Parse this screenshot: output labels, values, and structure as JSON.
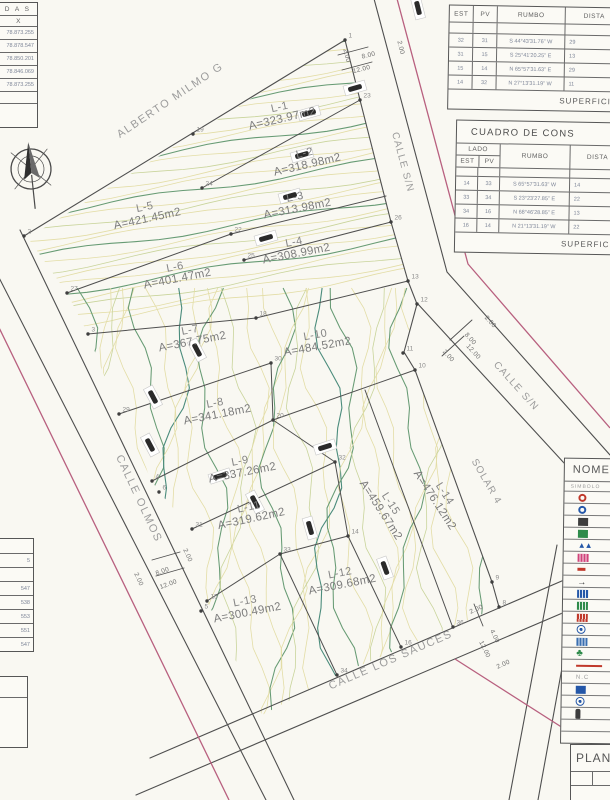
{
  "streets": {
    "alberto_milmo": "ALBERTO MILMO G",
    "calle_sn_top": "CALLE S/N",
    "calle_sn_right": "CALLE S/N",
    "calle_olmos": "CALLE OLMOS",
    "calle_los_sauces": "CALLE LOS SAUCES",
    "solar4": "SOLAR 4"
  },
  "lots": [
    {
      "name": "L-1",
      "area": "A=323.97m2",
      "x": 283,
      "y": 122,
      "r": -13
    },
    {
      "name": "L-2",
      "area": "A=318.98m2",
      "x": 308,
      "y": 168,
      "r": -13
    },
    {
      "name": "L-3",
      "area": "A=313.98m2",
      "x": 298,
      "y": 212,
      "r": -11
    },
    {
      "name": "L-4",
      "area": "A=308.99m2",
      "x": 297,
      "y": 257,
      "r": -11
    },
    {
      "name": "L-5",
      "area": "A=421.45m2",
      "x": 148,
      "y": 222,
      "r": -12
    },
    {
      "name": "L-6",
      "area": "A=401.47m2",
      "x": 178,
      "y": 282,
      "r": -11
    },
    {
      "name": "L-7",
      "area": "A=367.75m2",
      "x": 193,
      "y": 345,
      "r": -11
    },
    {
      "name": "L-8",
      "area": "A=341.18m2",
      "x": 218,
      "y": 418,
      "r": -11
    },
    {
      "name": "L-9",
      "area": "A=337.26m2",
      "x": 243,
      "y": 476,
      "r": -11
    },
    {
      "name": "L-10",
      "area": "A=484.52m2",
      "x": 318,
      "y": 350,
      "r": -10
    },
    {
      "name": "L-11",
      "area": "A=319.62m2",
      "x": 252,
      "y": 522,
      "r": -12
    },
    {
      "name": "L-12",
      "area": "A=309.68m2",
      "x": 343,
      "y": 588,
      "r": -11
    },
    {
      "name": "L-13",
      "area": "A=300.49m2",
      "x": 248,
      "y": 616,
      "r": -11
    },
    {
      "name": "L-14",
      "area": "A=476.12m2",
      "x": 432,
      "y": 502,
      "r": 57
    },
    {
      "name": "L-15",
      "area": "A=459.67m2",
      "x": 378,
      "y": 512,
      "r": 57
    }
  ],
  "vertices": [
    {
      "n": "1",
      "x": 345,
      "y": 40
    },
    {
      "n": "2",
      "x": 24,
      "y": 236
    },
    {
      "n": "3",
      "x": 88,
      "y": 334
    },
    {
      "n": "4",
      "x": 152,
      "y": 481
    },
    {
      "n": "5",
      "x": 201,
      "y": 611
    },
    {
      "n": "6",
      "x": 159,
      "y": 492
    },
    {
      "n": "8",
      "x": 499,
      "y": 607
    },
    {
      "n": "9",
      "x": 492,
      "y": 582
    },
    {
      "n": "10",
      "x": 415,
      "y": 370
    },
    {
      "n": "11",
      "x": 403,
      "y": 353
    },
    {
      "n": "12",
      "x": 417,
      "y": 304
    },
    {
      "n": "13",
      "x": 408,
      "y": 281
    },
    {
      "n": "14",
      "x": 348,
      "y": 536
    },
    {
      "n": "15",
      "x": 207,
      "y": 601
    },
    {
      "n": "16",
      "x": 401,
      "y": 647
    },
    {
      "n": "18",
      "x": 256,
      "y": 318
    },
    {
      "n": "19",
      "x": 193,
      "y": 134
    },
    {
      "n": "20",
      "x": 273,
      "y": 420
    },
    {
      "n": "22",
      "x": 231,
      "y": 234
    },
    {
      "n": "23",
      "x": 360,
      "y": 100
    },
    {
      "n": "24",
      "x": 202,
      "y": 188
    },
    {
      "n": "25",
      "x": 244,
      "y": 260
    },
    {
      "n": "26",
      "x": 391,
      "y": 222
    },
    {
      "n": "27",
      "x": 67,
      "y": 293
    },
    {
      "n": "29",
      "x": 119,
      "y": 414
    },
    {
      "n": "30",
      "x": 271,
      "y": 363
    },
    {
      "n": "31",
      "x": 192,
      "y": 529
    },
    {
      "n": "32",
      "x": 335,
      "y": 462
    },
    {
      "n": "33",
      "x": 280,
      "y": 554
    },
    {
      "n": "34",
      "x": 337,
      "y": 675
    },
    {
      "n": "36",
      "x": 453,
      "y": 627
    }
  ],
  "dim_labels": [
    {
      "t": "8.00",
      "x": 369,
      "y": 57,
      "r": -14
    },
    {
      "t": "12.00",
      "x": 362,
      "y": 71,
      "r": -14
    },
    {
      "t": "2.00",
      "x": 345,
      "y": 56,
      "r": 76
    },
    {
      "t": "2.00",
      "x": 399,
      "y": 48,
      "r": 76
    },
    {
      "t": "2.00",
      "x": 489,
      "y": 323,
      "r": 48
    },
    {
      "t": "8.00",
      "x": 469,
      "y": 340,
      "r": 48
    },
    {
      "t": "12.00",
      "x": 472,
      "y": 353,
      "r": 48
    },
    {
      "t": "2.00",
      "x": 447,
      "y": 357,
      "r": 48
    },
    {
      "t": "2.00",
      "x": 186,
      "y": 556,
      "r": 66
    },
    {
      "t": "8.00",
      "x": 163,
      "y": 573,
      "r": -20
    },
    {
      "t": "12.00",
      "x": 169,
      "y": 586,
      "r": -20
    },
    {
      "t": "2.00",
      "x": 137,
      "y": 580,
      "r": 66
    },
    {
      "t": "2.00",
      "x": 477,
      "y": 611,
      "r": -24
    },
    {
      "t": "4.00",
      "x": 493,
      "y": 637,
      "r": 64
    },
    {
      "t": "12.00",
      "x": 483,
      "y": 650,
      "r": 64
    },
    {
      "t": "2.00",
      "x": 504,
      "y": 666,
      "r": -24
    }
  ],
  "tables": {
    "coords_top": {
      "header": "D A S",
      "axis": "X",
      "values": [
        "78.873.255",
        "78.878.547",
        "78.850.201",
        "78.846.069",
        "78.873.255"
      ]
    },
    "rumbo": {
      "col_est": "EST",
      "col_pv": "PV",
      "col_rumbo": "RUMBO",
      "col_dist": "DISTA",
      "rows": [
        {
          "est": "32",
          "pv": "31",
          "rumbo": "S 44°43'31.76\" W",
          "dist": "29"
        },
        {
          "est": "31",
          "pv": "15",
          "rumbo": "S 25°41'20.25\" E",
          "dist": "13"
        },
        {
          "est": "15",
          "pv": "14",
          "rumbo": "N 65°57'31.63\" E",
          "dist": "29"
        },
        {
          "est": "14",
          "pv": "32",
          "rumbo": "N 27°13'31.19\" W",
          "dist": "11"
        }
      ],
      "footer": "SUPERFICIE"
    },
    "cuadro": {
      "title": "CUADRO DE CONS",
      "lado": "LADO",
      "col_est": "EST",
      "col_pv": "PV",
      "col_rumbo": "RUMBO",
      "col_dist": "DISTA",
      "rows": [
        {
          "est": "14",
          "pv": "33",
          "rumbo": "S 65°57'31.63\" W",
          "dist": "14"
        },
        {
          "est": "33",
          "pv": "34",
          "rumbo": "S 23°23'27.85\" E",
          "dist": "22"
        },
        {
          "est": "34",
          "pv": "16",
          "rumbo": "N 68°46'28.85\" E",
          "dist": "13"
        },
        {
          "est": "16",
          "pv": "14",
          "rumbo": "N 21°13'31.19\" W",
          "dist": "22"
        }
      ],
      "footer": "SUPERFICIE"
    },
    "coords_bottom": {
      "values": [
        "5",
        "547",
        "538",
        "553",
        "551",
        "547"
      ]
    },
    "legend": {
      "title": "NOME",
      "subtitle": "SIMBOLO",
      "rows": [
        {
          "name": "symbol-red-circle",
          "shape": "circle",
          "color": "#c0392b"
        },
        {
          "name": "symbol-blue-circle",
          "shape": "circle",
          "color": "#2457a8"
        },
        {
          "name": "symbol-dark-square",
          "shape": "square",
          "color": "#3d3d3d"
        },
        {
          "name": "symbol-green-square",
          "shape": "square",
          "color": "#2e8b4a"
        },
        {
          "name": "symbol-blue-peaks",
          "shape": "peaks",
          "color": "#2457a8"
        },
        {
          "name": "symbol-pink-grid",
          "shape": "grid",
          "color": "#d1437a"
        },
        {
          "name": "symbol-red-dash",
          "shape": "dash",
          "color": "#c0392b"
        },
        {
          "name": "symbol-flow-arrow",
          "shape": "arrow",
          "color": "#3d3d3d"
        },
        {
          "name": "symbol-blue-grid",
          "shape": "grid",
          "color": "#2457a8"
        },
        {
          "name": "symbol-green-grid",
          "shape": "grid",
          "color": "#2e8b4a"
        },
        {
          "name": "symbol-red-grid",
          "shape": "grid",
          "color": "#c0392b"
        },
        {
          "name": "symbol-blue-target",
          "shape": "target",
          "color": "#2457a8"
        },
        {
          "name": "symbol-blue-checker",
          "shape": "grid",
          "color": "#3a6fb0"
        },
        {
          "name": "symbol-green-clover",
          "shape": "clover",
          "color": "#2e8b4a"
        },
        {
          "name": "symbol-red-line",
          "shape": "line",
          "color": "#c0392b"
        },
        {
          "name": "symbol-nc",
          "shape": "text",
          "label": "N.C",
          "color": "#9a9a9a"
        },
        {
          "name": "symbol-blue-box",
          "shape": "square",
          "color": "#2457a8"
        },
        {
          "name": "symbol-blue-emblem",
          "shape": "target",
          "color": "#2457a8"
        },
        {
          "name": "symbol-dark-bottle",
          "shape": "bottle",
          "color": "#3d3d3d"
        },
        {
          "name": "symbol-empty-1",
          "shape": "none",
          "color": "#000000"
        },
        {
          "name": "symbol-empty-2",
          "shape": "none",
          "color": "#000000"
        }
      ]
    },
    "plan": {
      "title": "PLAN"
    }
  },
  "colors": {
    "boundary_magenta": "#b8607f",
    "line_dark": "#4f4f4f",
    "contour_light": "#e3dda6",
    "contour_mid": "#c9d49b",
    "contour_dark": "#679b74",
    "contour_teal": "#4b8c7c"
  }
}
